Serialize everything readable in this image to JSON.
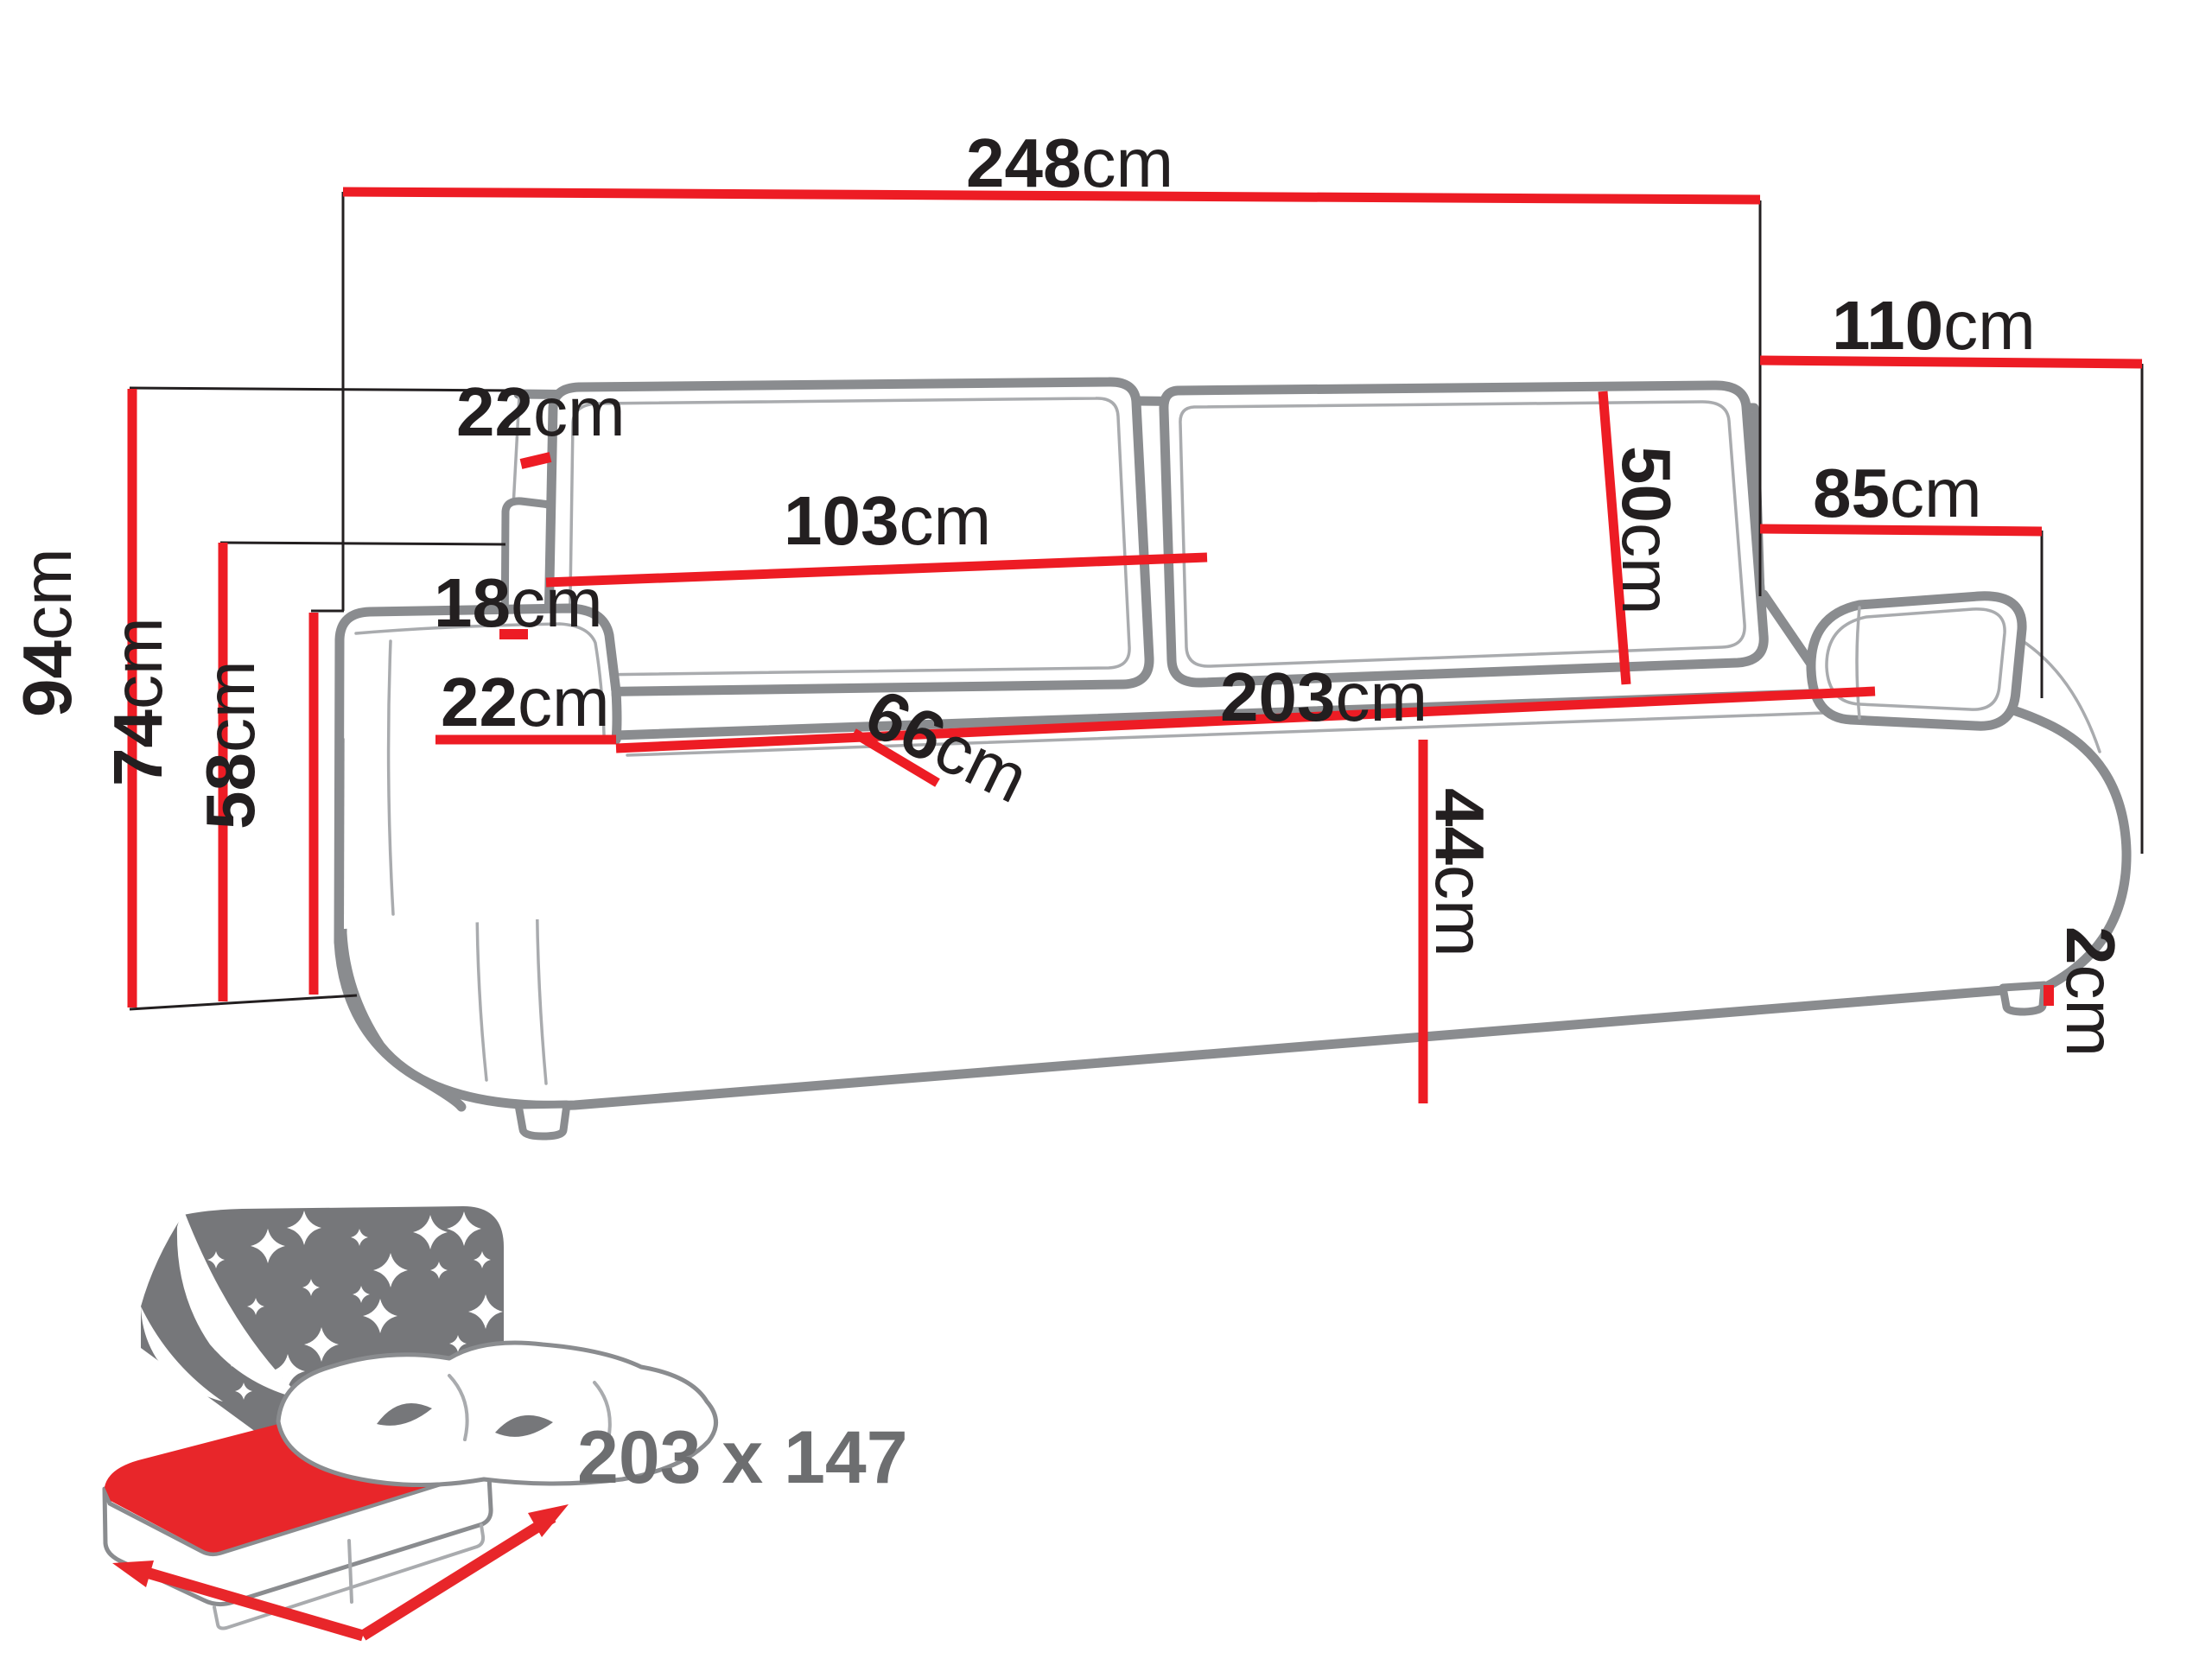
{
  "diagram": {
    "type": "sofa-bed dimension diagram",
    "units": "cm"
  },
  "colors": {
    "dimension_red": "#ed1c24",
    "icon_red": "#e8262a",
    "outline_gray": "#8a8c8f",
    "thin_line_gray": "#a9abae",
    "icon_panel_gray": "#76777a",
    "text_black": "#231f20",
    "sleeping_label_gray": "#6d6e70"
  },
  "dims": {
    "total_width": {
      "value": "248",
      "unit": "cm"
    },
    "total_depth": {
      "value": "110",
      "unit": "cm"
    },
    "back_top_depth": {
      "value": "22",
      "unit": "cm"
    },
    "cushion_width": {
      "value": "103",
      "unit": "cm"
    },
    "cushion_height": {
      "value": "50",
      "unit": "cm"
    },
    "arm_to_back_depth": {
      "value": "85",
      "unit": "cm"
    },
    "side_gap": {
      "value": "18",
      "unit": "cm"
    },
    "armrest_width": {
      "value": "22",
      "unit": "cm"
    },
    "seat_depth": {
      "value": "66",
      "unit": "cm"
    },
    "seat_width": {
      "value": "203",
      "unit": "cm"
    },
    "seat_height": {
      "value": "44",
      "unit": "cm"
    },
    "total_height": {
      "value": "94",
      "unit": "cm"
    },
    "back_height": {
      "value": "74",
      "unit": "cm"
    },
    "armrest_height": {
      "value": "58",
      "unit": "cm"
    },
    "leg_height": {
      "value": "2",
      "unit": "cm"
    }
  },
  "sleeping_area": {
    "text": "203 x 147"
  }
}
